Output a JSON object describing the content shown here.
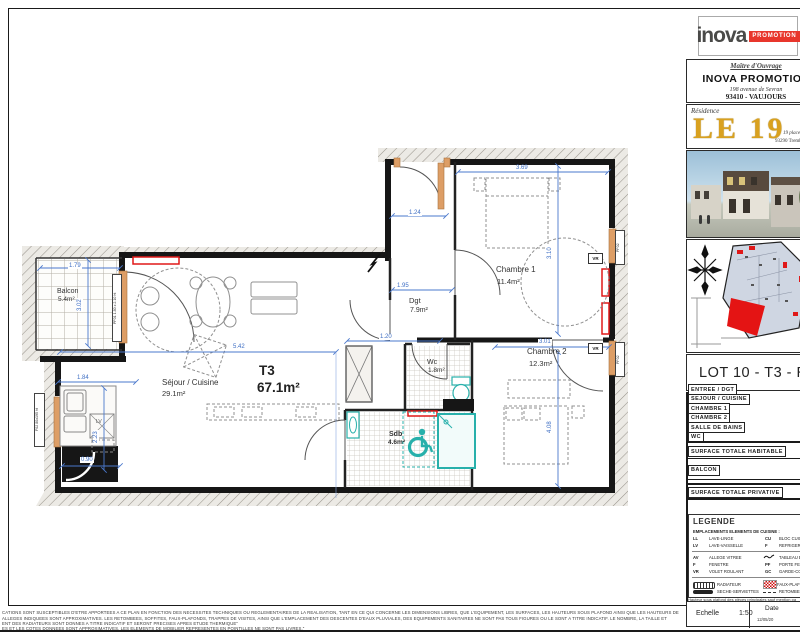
{
  "plan": {
    "type": {
      "name": "T3",
      "area": "67.1m²"
    },
    "rooms": {
      "balcon": {
        "name": "Balcon",
        "area": "5.4m²"
      },
      "sejour": {
        "name": "Séjour / Cuisine",
        "area": "29.1m²"
      },
      "chambre1": {
        "name": "Chambre 1",
        "area": "11.4m²"
      },
      "dgt": {
        "name": "Dgt",
        "area": "7.9m²"
      },
      "chambre2": {
        "name": "Chambre 2",
        "area": "12.3m²"
      },
      "wc": {
        "name": "Wc",
        "area": "1.8m²"
      },
      "sdb": {
        "name": "Sdb",
        "area": "4.6m²"
      }
    },
    "dims": [
      "1.79",
      "3.02",
      "1.24",
      "3.69",
      "3.10",
      "5.42",
      "1.95",
      "1.20",
      "3.01",
      "4.08",
      "1.84",
      "2.23",
      "0.90"
    ],
    "wall_labels": {
      "pf01": "PF01 1.80 x 2.10 ht",
      "pf02": "PF02",
      "f02": "F02 80x195 ht",
      "vr": "VR",
      "lv": "LV"
    }
  },
  "panel": {
    "logo": {
      "brand": "inova",
      "badge": "PROMOTION"
    },
    "owner": {
      "heading": "Maître d'Ouvrage",
      "name": "INOVA PROMOTION",
      "address1": "198 avenue de Sevran",
      "address2": "93410 - VAUJOURS"
    },
    "residence": {
      "label": "Résidence",
      "name": "LE 19",
      "addr1": "19 place",
      "addr2": "93290 Tremblay"
    },
    "lot_title": "LOT 10 - T3 - R",
    "rooms_rows": [
      "ENTREE / DGT",
      "SEJOUR / CUISINE",
      "CHAMBRE 1",
      "CHAMBRE 2",
      "SALLE DE BAINS",
      "WC"
    ],
    "total_habitable": "SURFACE TOTALE HABITABLE",
    "balcon_row": "BALCON",
    "total_privative": "SURFACE TOTALE PRIVATIVE",
    "legend": {
      "title": "LEGENDE",
      "subtitle": "EMPLACEMENTS ELEMENTS DE CUISINE :",
      "ll_k": "LL",
      "ll_v": "LAVE-LINGE",
      "cu_k": "CU",
      "cu_v": "BLOC CUISINE",
      "lv_k": "LV",
      "lv_v": "LAVE-VAISSELLE",
      "f1_k": "F",
      "f1_v": "REFRIGERATEUR",
      "av_k": "AV",
      "av_v": "ALLEGE VITREE",
      "te_v": "TABLEAU ELECTRIQUE",
      "f2_k": "F",
      "f2_v": "FENETRE",
      "pf_k": "PF",
      "pf_v": "PORTE FENETRE",
      "vr_k": "VR",
      "vr_v": "VOLET ROULANT",
      "gc_k": "GC",
      "gc_v": "GARDE-CORPS",
      "radiateur": "RADIATEUR",
      "faux_plafond": "FAUX-PLAFOND",
      "seche": "SECHE-SERVIETTES",
      "retombee": "RETOMBEE",
      "note": "Hauteur sous plafond des pièces principales sauf mention pa"
    },
    "scale_label": "Echelle",
    "scale_value": "1:50",
    "date_label": "Date",
    "date_value": "12/05/20"
  },
  "disclaimer": {
    "line1": "CATIONS SONT SUSCEPTIBLES D'ETRE APPORTEES A CE PLAN EN FONCTION DES NECESSITES TECHNIQUES OU REGLEMENTAIRES DE LA REALISATION, TANT EN CE QUI CONCERNE LES DIMENSIONS LIBRES, QUE L'EQUIPEMENT, LES SURFACES, LES HAUTEURS SOUS PLAFOND AINSI QUE LES HAUTEURS DE",
    "line2": "ALLEGES INDIQUEES SONT APPROXIMATIVES. LES RETOMBEES, SOFFITES, FAUX-PLAFONDS, TRAPPES DE VISITES, AINSI QUE L'EMPLACEMENT DES DESCENTES D'EAUX PLUVIALES, DES EQUIPEMENTS SANITAIRES NE SONT PAS TOUS FIGURES OU LE SONT A TITRE INDICATIF. LE NOMBRE, LA TAILLE ET",
    "line3": "ENT DES RADIATEURS SONT DONNES A TITRE INDICATIF ET SERONT PRECISES APRES ETUDE THERMIQUE\"",
    "line4": "ES ET LES COTES DONNEES SONT APPROXIMATIVES. LES ELEMENTS DE MOBILIER REPRESENTES EN POINTILLES NE SONT PAS LIVRES.\""
  }
}
